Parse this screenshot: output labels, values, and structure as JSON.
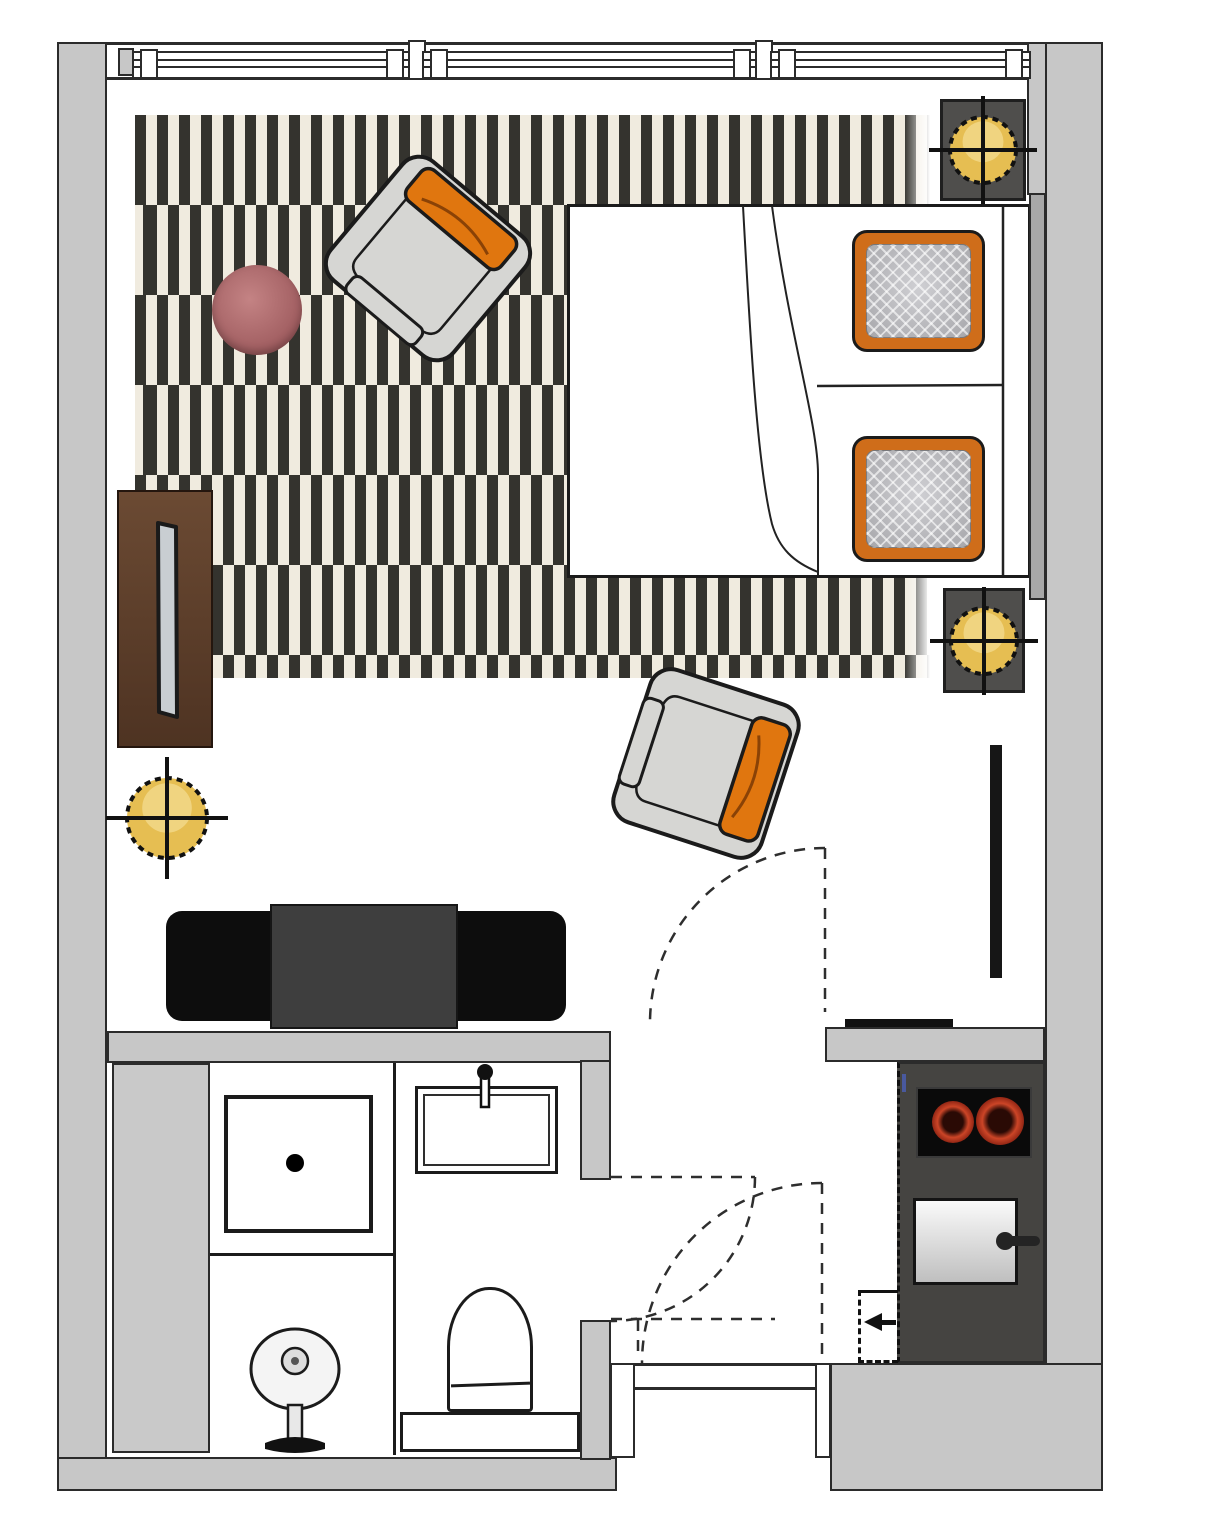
{
  "document": {
    "kind": "floor-plan",
    "description": "Top-view studio apartment floor plan with living/sleeping area, bathroom, hall and kitchenette",
    "visible_text": []
  },
  "colors": {
    "wall_fill": "#c7c7c7",
    "wall_line": "#2b2b2b",
    "line_black": "#1b1b1b",
    "floor_white": "#ffffff",
    "rug_dark": "#34332e",
    "rug_cream": "#f0ebdf",
    "accent_orange": "#e0760f",
    "pillow_orange": "#cf6d1a",
    "pillow_gray": "#b3b3b6",
    "chair_gray": "#d6d6d3",
    "wood_dark": "#5d3d28",
    "table_mauve": "#b06d6f",
    "light_yellow": "#e6be52",
    "unit_dark": "#454441",
    "cooktop_black": "#0a0a0a",
    "burner_red": "#cc4527",
    "sideboard_black": "#0d0d0d",
    "sideboard_gray": "#3e3e3e",
    "headboard_gray": "#a8a8a8",
    "install_gray": "#c9c9c9"
  },
  "rug": {
    "left": 135,
    "top": 115,
    "width": 795,
    "height": 563,
    "rows": 7,
    "row_height": 90,
    "stripe_width": 11
  },
  "lights": [
    {
      "name": "ceiling-light-bed-top",
      "cx": 983,
      "cy": 150,
      "r": 33
    },
    {
      "name": "ceiling-light-bed-bottom",
      "cx": 984,
      "cy": 641,
      "r": 33
    },
    {
      "name": "ceiling-light-living",
      "cx": 167,
      "cy": 818,
      "r": 40
    }
  ],
  "elements": [
    {
      "name": "window-band",
      "kind": "triple window along top wall"
    },
    {
      "name": "area-rug",
      "kind": "black and cream striped rug"
    },
    {
      "name": "armchair-1",
      "kind": "armchair with orange back cushion, rotated toward room"
    },
    {
      "name": "armchair-2",
      "kind": "armchair with orange back cushion, near room door"
    },
    {
      "name": "side-table",
      "kind": "round mauve side table"
    },
    {
      "name": "wardrobe",
      "kind": "dark wood wardrobe with mirror slot"
    },
    {
      "name": "double-bed",
      "kind": "double bed with duvet fold lines"
    },
    {
      "name": "pillow-top",
      "kind": "pillow with orange trim and gray quilted center"
    },
    {
      "name": "pillow-bottom",
      "kind": "pillow with orange trim and gray quilted center"
    },
    {
      "name": "nightstand-top",
      "kind": "dark nightstand with ceiling light symbol"
    },
    {
      "name": "nightstand-bottom",
      "kind": "dark nightstand with ceiling light symbol"
    },
    {
      "name": "sideboard",
      "kind": "black/gray TV lowboard"
    },
    {
      "name": "radiator",
      "kind": "wall radiator bar"
    },
    {
      "name": "shower",
      "kind": "shower tray with drain"
    },
    {
      "name": "washbasin-pedestal",
      "kind": "pedestal wash basin"
    },
    {
      "name": "sink",
      "kind": "rectangular basin with faucet"
    },
    {
      "name": "toilet",
      "kind": "toilet on plinth"
    },
    {
      "name": "cooktop",
      "kind": "two-burner cooktop"
    },
    {
      "name": "oven",
      "kind": "oven/fridge unit with door handle"
    },
    {
      "name": "door-swings",
      "kind": "dashed door swing arcs (room, bathroom, entry doors)"
    }
  ]
}
